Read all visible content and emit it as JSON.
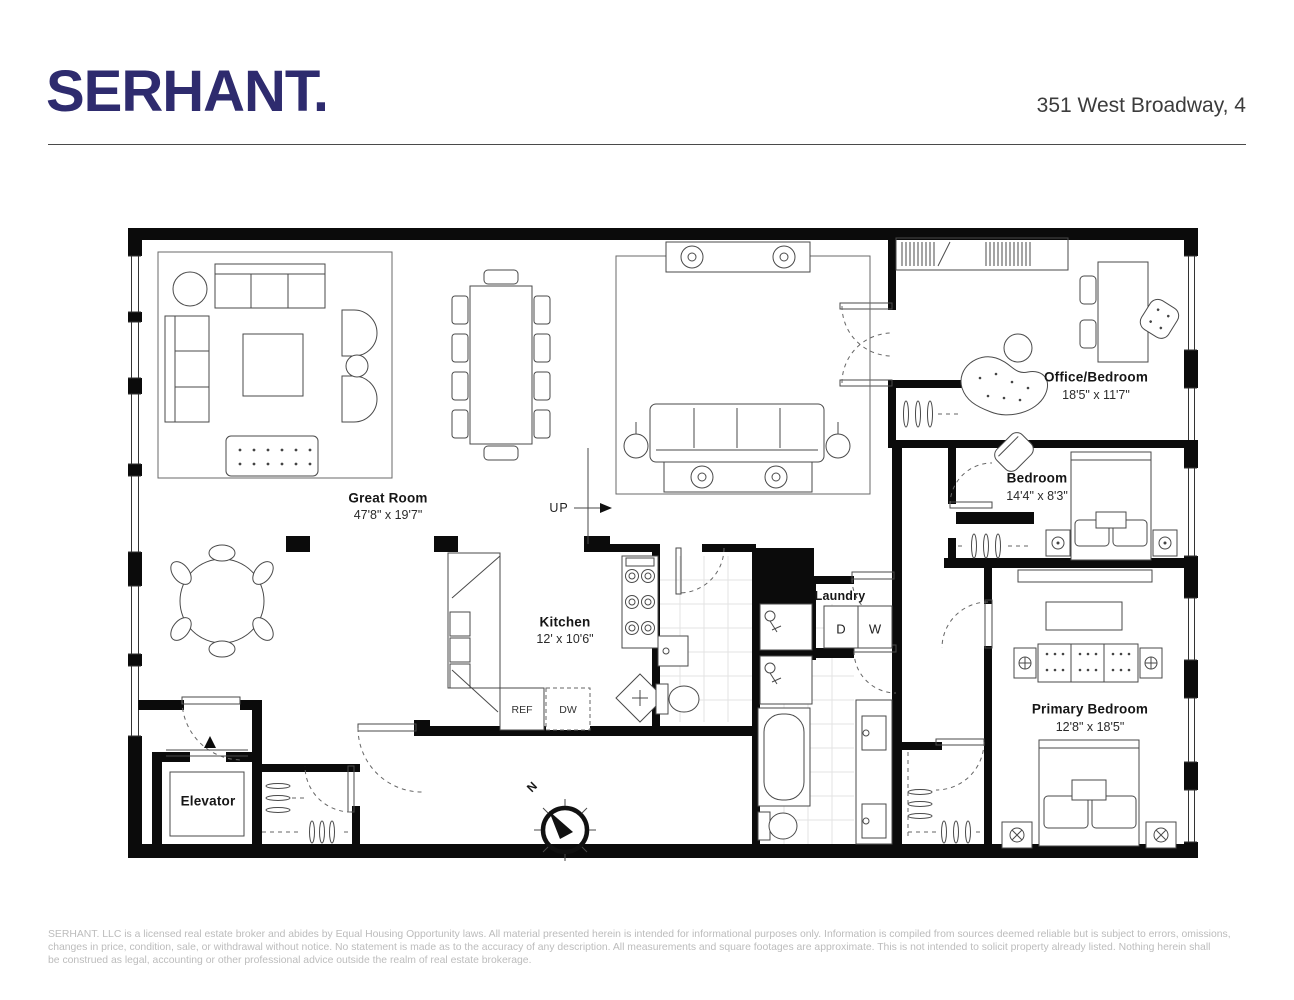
{
  "header": {
    "logo": "SERHANT.",
    "address": "351 West Broadway, 4"
  },
  "rooms": {
    "great_room": {
      "name": "Great Room",
      "dims": "47'8\" x 19'7\""
    },
    "kitchen": {
      "name": "Kitchen",
      "dims": "12' x 10'6\""
    },
    "office_bedroom": {
      "name": "Office/Bedroom",
      "dims": "18'5\" x 11'7\""
    },
    "bedroom": {
      "name": "Bedroom",
      "dims": "14'4\" x 8'3\""
    },
    "primary_bedroom": {
      "name": "Primary Bedroom",
      "dims": "12'8\" x 18'5\""
    },
    "laundry": {
      "name": "Laundry"
    },
    "elevator": {
      "name": "Elevator"
    }
  },
  "appliances": {
    "refrigerator": "REF",
    "dishwasher": "DW",
    "dryer": "D",
    "washer": "W"
  },
  "annotations": {
    "stairs_up": "UP",
    "north": "N"
  },
  "colors": {
    "logo_navy": "#2e2b6e",
    "wall_black": "#0b0b0b",
    "footer_gray": "#bcbcbc"
  },
  "footer": {
    "lines": [
      "SERHANT. LLC is a licensed real estate broker and abides by Equal Housing Opportunity laws. All material presented herein is intended for informational purposes only. Information is compiled from sources deemed  reliable but is subject to errors, omissions,",
      "changes in price, condition, sale, or withdrawal without notice. No statement is made as to the accuracy of any description. All measurements and square footages are approximate. This is not intended to solicit property already listed. Nothing herein shall",
      "be construed as legal, accounting or other professional advice outside the realm of real estate brokerage."
    ]
  }
}
